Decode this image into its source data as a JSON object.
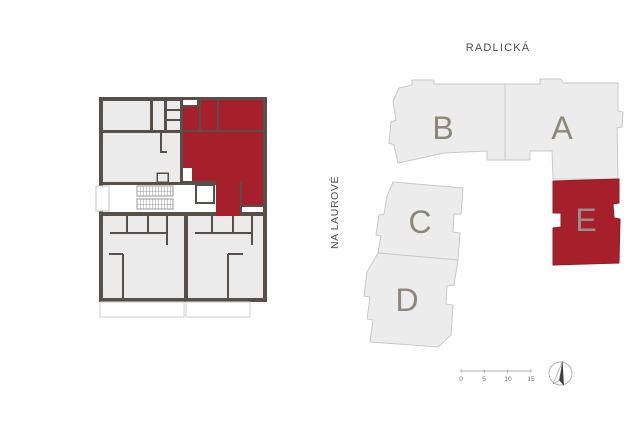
{
  "streets": {
    "top": "RADLICKÁ",
    "left": "NA LAUROVÉ"
  },
  "site_plan": {
    "buildings": [
      {
        "label": "B",
        "highlighted": false
      },
      {
        "label": "A",
        "highlighted": false
      },
      {
        "label": "C",
        "highlighted": false
      },
      {
        "label": "D",
        "highlighted": false
      },
      {
        "label": "E",
        "highlighted": true
      }
    ],
    "scale_bar": {
      "labels": [
        "0",
        "5",
        "10",
        "15"
      ]
    },
    "north_arrow_icon": "north-arrow-icon"
  },
  "floor_plan": {
    "highlighted_unit": "E",
    "highlighted_unit_color": "#a6202b"
  },
  "colors": {
    "accent_red": "#a6202b",
    "wall_dark": "#57504a",
    "room_fill": "#ebebeb",
    "building_fill": "#ececec",
    "building_stroke": "#c9c9c9",
    "building_label_gray": "#8e8779",
    "street_text": "#4f4f4e"
  }
}
